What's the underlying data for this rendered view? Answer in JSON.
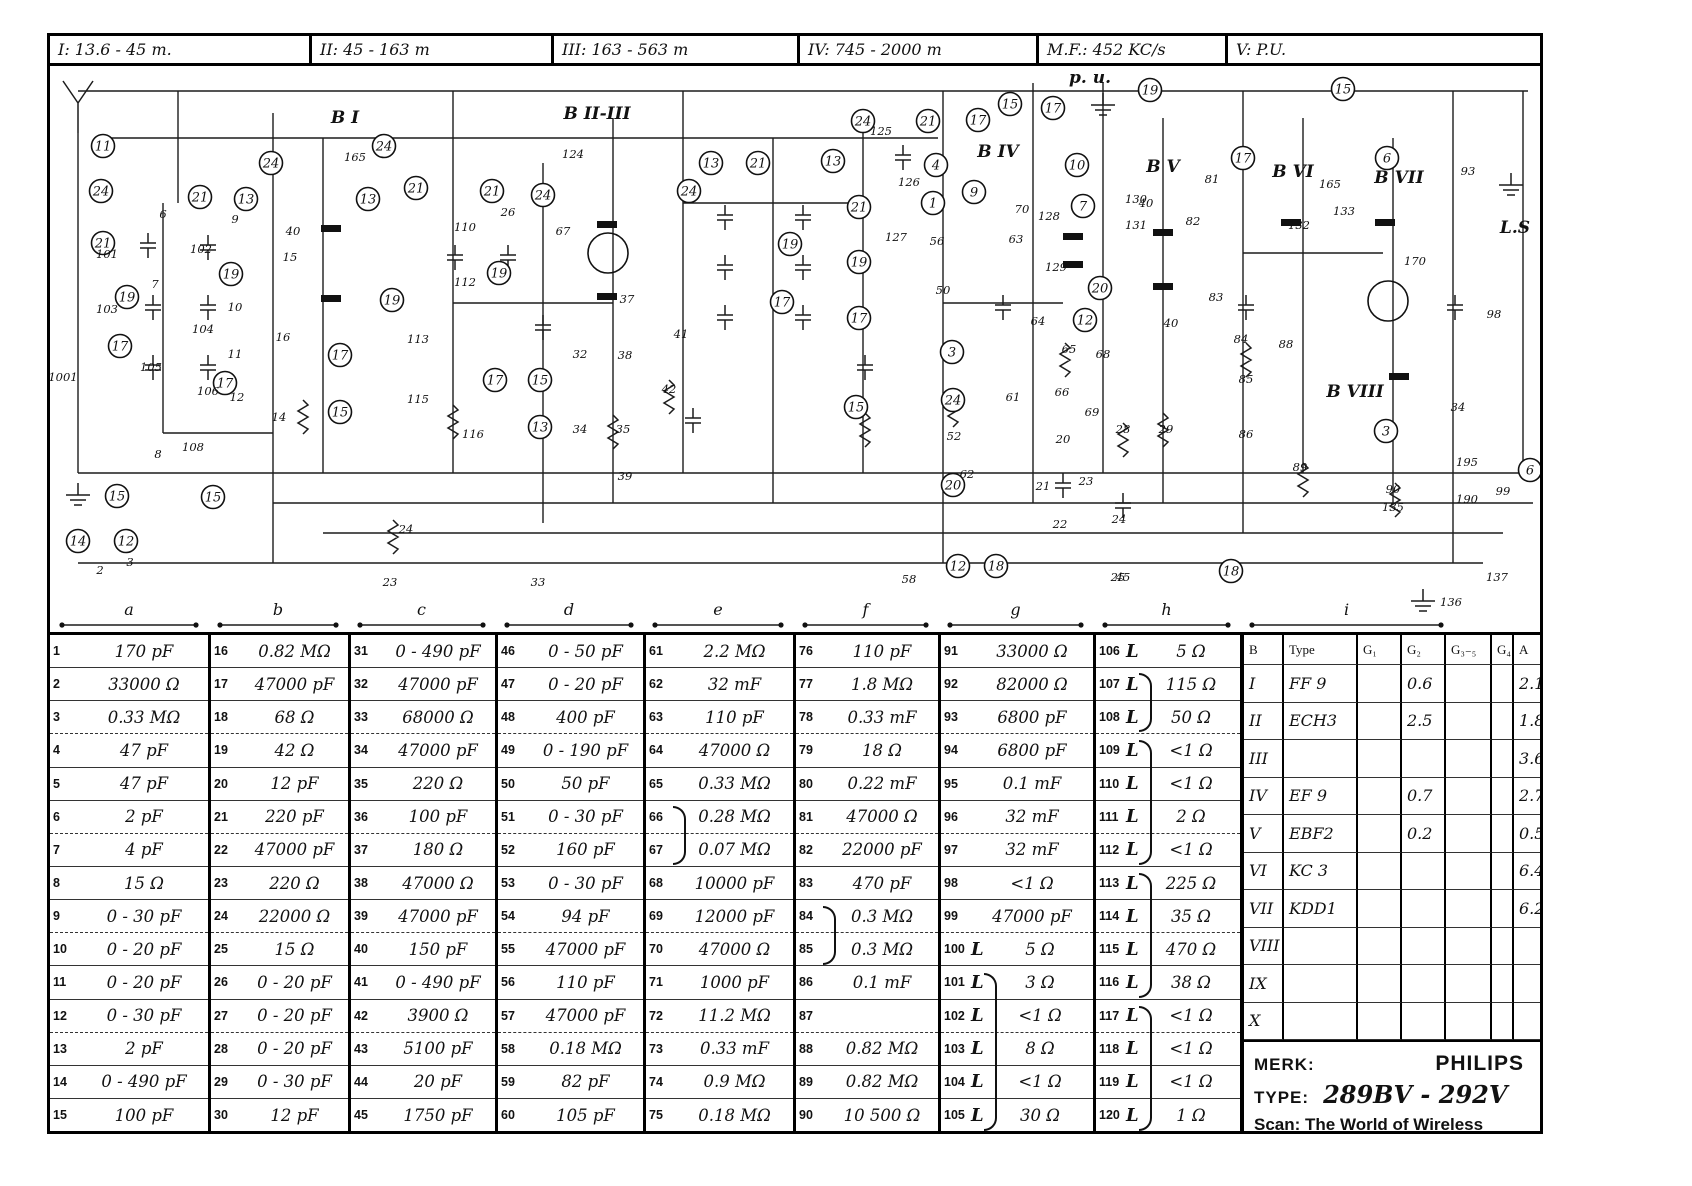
{
  "bands": [
    {
      "label": "I: 13.6 - 45 m."
    },
    {
      "label": "II: 45 - 163 m"
    },
    {
      "label": "III: 163 - 563 m"
    },
    {
      "label": "IV: 745 - 2000 m"
    },
    {
      "label": "M.F.: 452 KC/s"
    },
    {
      "label": "V: P.U."
    }
  ],
  "parts": {
    "group_letters": [
      "a",
      "b",
      "c",
      "d",
      "e",
      "f",
      "g",
      "h",
      "i"
    ],
    "entries": [
      [
        "1",
        "170 pF"
      ],
      [
        "2",
        "33000 Ω"
      ],
      [
        "3",
        "0.33 MΩ"
      ],
      [
        "4",
        "47 pF"
      ],
      [
        "5",
        "47 pF"
      ],
      [
        "6",
        "2 pF"
      ],
      [
        "7",
        "4 pF"
      ],
      [
        "8",
        "15 Ω"
      ],
      [
        "9",
        "0 - 30 pF"
      ],
      [
        "10",
        "0 - 20 pF"
      ],
      [
        "11",
        "0 - 20 pF"
      ],
      [
        "12",
        "0 - 30 pF"
      ],
      [
        "13",
        "2 pF"
      ],
      [
        "14",
        "0 - 490 pF"
      ],
      [
        "15",
        "100 pF"
      ],
      [
        "16",
        "0.82 MΩ"
      ],
      [
        "17",
        "47000 pF"
      ],
      [
        "18",
        "68 Ω"
      ],
      [
        "19",
        "42 Ω"
      ],
      [
        "20",
        "12 pF"
      ],
      [
        "21",
        "220 pF"
      ],
      [
        "22",
        "47000 pF"
      ],
      [
        "23",
        "220 Ω"
      ],
      [
        "24",
        "22000 Ω"
      ],
      [
        "25",
        "15 Ω"
      ],
      [
        "26",
        "0 - 20 pF"
      ],
      [
        "27",
        "0 - 20 pF"
      ],
      [
        "28",
        "0 - 20 pF"
      ],
      [
        "29",
        "0 - 30 pF"
      ],
      [
        "30",
        "12 pF"
      ],
      [
        "31",
        "0 - 490 pF"
      ],
      [
        "32",
        "47000 pF"
      ],
      [
        "33",
        "68000 Ω"
      ],
      [
        "34",
        "47000 pF"
      ],
      [
        "35",
        "220 Ω"
      ],
      [
        "36",
        "100 pF"
      ],
      [
        "37",
        "180 Ω"
      ],
      [
        "38",
        "47000 Ω"
      ],
      [
        "39",
        "47000 pF"
      ],
      [
        "40",
        "150 pF"
      ],
      [
        "41",
        "0 - 490 pF"
      ],
      [
        "42",
        "3900 Ω"
      ],
      [
        "43",
        "5100 pF"
      ],
      [
        "44",
        "20 pF"
      ],
      [
        "45",
        "1750 pF"
      ],
      [
        "46",
        "0 - 50 pF"
      ],
      [
        "47",
        "0 - 20 pF"
      ],
      [
        "48",
        "400 pF"
      ],
      [
        "49",
        "0 - 190 pF"
      ],
      [
        "50",
        "50 pF"
      ],
      [
        "51",
        "0 - 30 pF"
      ],
      [
        "52",
        "160 pF"
      ],
      [
        "53",
        "0 - 30 pF"
      ],
      [
        "54",
        "94 pF"
      ],
      [
        "55",
        "47000 pF"
      ],
      [
        "56",
        "110 pF"
      ],
      [
        "57",
        "47000 pF"
      ],
      [
        "58",
        "0.18 MΩ"
      ],
      [
        "59",
        "82 pF"
      ],
      [
        "60",
        "105 pF"
      ],
      [
        "61",
        "2.2 MΩ"
      ],
      [
        "62",
        "32 mF"
      ],
      [
        "63",
        "110 pF"
      ],
      [
        "64",
        "47000 Ω"
      ],
      [
        "65",
        "0.33 MΩ"
      ],
      [
        "66",
        "0.28 MΩ"
      ],
      [
        "67",
        "0.07 MΩ"
      ],
      [
        "68",
        "10000 pF"
      ],
      [
        "69",
        "12000 pF"
      ],
      [
        "70",
        "47000 Ω"
      ],
      [
        "71",
        "1000 pF"
      ],
      [
        "72",
        "11.2 MΩ"
      ],
      [
        "73",
        "0.33 mF"
      ],
      [
        "74",
        "0.9 MΩ"
      ],
      [
        "75",
        "0.18 MΩ"
      ],
      [
        "76",
        "110 pF"
      ],
      [
        "77",
        "1.8 MΩ"
      ],
      [
        "78",
        "0.33 mF"
      ],
      [
        "79",
        "18 Ω"
      ],
      [
        "80",
        "0.22 mF"
      ],
      [
        "81",
        "47000 Ω"
      ],
      [
        "82",
        "22000 pF"
      ],
      [
        "83",
        "470 pF"
      ],
      [
        "84",
        "0.3 MΩ"
      ],
      [
        "85",
        "0.3 MΩ"
      ],
      [
        "86",
        "0.1 mF"
      ],
      [
        "87",
        ""
      ],
      [
        "88",
        "0.82 MΩ"
      ],
      [
        "89",
        "0.82 MΩ"
      ],
      [
        "90",
        "10 500 Ω"
      ],
      [
        "91",
        "33000 Ω"
      ],
      [
        "92",
        "82000 Ω"
      ],
      [
        "93",
        "6800 pF"
      ],
      [
        "94",
        "6800 pF"
      ],
      [
        "95",
        "0.1 mF"
      ],
      [
        "96",
        "32 mF"
      ],
      [
        "97",
        "32 mF"
      ],
      [
        "98",
        "<1 Ω"
      ],
      [
        "99",
        "47000 pF"
      ],
      [
        "100",
        "5 Ω",
        "L"
      ],
      [
        "101",
        "3 Ω",
        "L"
      ],
      [
        "102",
        "<1 Ω",
        "L"
      ],
      [
        "103",
        "8 Ω",
        "L"
      ],
      [
        "104",
        "<1 Ω",
        "L"
      ],
      [
        "105",
        "30 Ω",
        "L"
      ],
      [
        "106",
        "5 Ω",
        "L"
      ],
      [
        "107",
        "115 Ω",
        "L"
      ],
      [
        "108",
        "50 Ω",
        "L"
      ],
      [
        "109",
        "<1 Ω",
        "L"
      ],
      [
        "110",
        "<1 Ω",
        "L"
      ],
      [
        "111",
        "2 Ω",
        "L"
      ],
      [
        "112",
        "<1 Ω",
        "L"
      ],
      [
        "113",
        "225 Ω",
        "L"
      ],
      [
        "114",
        "35 Ω",
        "L"
      ],
      [
        "115",
        "470 Ω",
        "L"
      ],
      [
        "116",
        "38 Ω",
        "L"
      ],
      [
        "117",
        "<1 Ω",
        "L"
      ],
      [
        "118",
        "<1 Ω",
        "L"
      ],
      [
        "119",
        "<1 Ω",
        "L"
      ],
      [
        "120",
        "1 Ω",
        "L"
      ]
    ],
    "braces": [
      {
        "c": 4,
        "f": 5,
        "t": 6
      },
      {
        "c": 5,
        "f": 8,
        "t": 9
      },
      {
        "c": 6,
        "f": 10,
        "t": 14
      },
      {
        "c": 7,
        "f": 1,
        "t": 2
      },
      {
        "c": 7,
        "f": 3,
        "t": 6
      },
      {
        "c": 7,
        "f": 7,
        "t": 10
      },
      {
        "c": 7,
        "f": 11,
        "t": 14
      }
    ]
  },
  "tubes": {
    "headers": [
      "B",
      "Type",
      "G₁",
      "G₂",
      "G₃₋₅",
      "G₄",
      "A"
    ],
    "rows": [
      {
        "b": "I",
        "type": "FF 9",
        "g1": "",
        "g2": "0.6",
        "g35": "",
        "g4": "",
        "a": "2.1"
      },
      {
        "b": "II",
        "type": "ECH3",
        "g1": "",
        "g2": "2.5",
        "g35": "",
        "g4": "",
        "a": "1.8"
      },
      {
        "b": "III",
        "type": "",
        "g1": "",
        "g2": "",
        "g35": "",
        "g4": "",
        "a": "3.6"
      },
      {
        "b": "IV",
        "type": "EF 9",
        "g1": "",
        "g2": "0.7",
        "g35": "",
        "g4": "",
        "a": "2.7"
      },
      {
        "b": "V",
        "type": "EBF2",
        "g1": "",
        "g2": "0.2",
        "g35": "",
        "g4": "",
        "a": "0.5"
      },
      {
        "b": "VI",
        "type": "KC 3",
        "g1": "",
        "g2": "",
        "g35": "",
        "g4": "",
        "a": "6.4"
      },
      {
        "b": "VII",
        "type": "KDD1",
        "g1": "",
        "g2": "",
        "g35": "",
        "g4": "",
        "a": "6.2"
      },
      {
        "b": "VIII",
        "type": "",
        "g1": "",
        "g2": "",
        "g35": "",
        "g4": "",
        "a": ""
      },
      {
        "b": "IX",
        "type": "",
        "g1": "",
        "g2": "",
        "g35": "",
        "g4": "",
        "a": ""
      },
      {
        "b": "X",
        "type": "",
        "g1": "",
        "g2": "",
        "g35": "",
        "g4": "",
        "a": ""
      }
    ]
  },
  "brand": {
    "merk_label": "MERK:",
    "merk_value": "PHILIPS",
    "type_label": "TYPE:",
    "type_value": "289BV - 292V",
    "scan": "Scan: The World of Wireless"
  },
  "schematic": {
    "block_labels": [
      [
        "B I",
        342,
        120
      ],
      [
        "B II-III",
        594,
        116
      ],
      [
        "B IV",
        995,
        154
      ],
      [
        "B V",
        1160,
        169
      ],
      [
        "B VI",
        1290,
        174
      ],
      [
        "B VII",
        1396,
        180
      ],
      [
        "B VIII",
        1352,
        394
      ],
      [
        "p. u.",
        1087,
        80
      ],
      [
        "L.S",
        1512,
        230
      ]
    ],
    "circles": [
      [
        11,
        100,
        143
      ],
      [
        24,
        98,
        188
      ],
      [
        21,
        100,
        240
      ],
      [
        19,
        124,
        294
      ],
      [
        17,
        117,
        343
      ],
      [
        15,
        114,
        493
      ],
      [
        14,
        75,
        538
      ],
      [
        12,
        123,
        538
      ],
      [
        21,
        197,
        194
      ],
      [
        13,
        243,
        196
      ],
      [
        19,
        228,
        271
      ],
      [
        17,
        222,
        380
      ],
      [
        15,
        210,
        494
      ],
      [
        24,
        268,
        160
      ],
      [
        13,
        365,
        196
      ],
      [
        24,
        381,
        143
      ],
      [
        21,
        413,
        185
      ],
      [
        19,
        389,
        297
      ],
      [
        17,
        337,
        352
      ],
      [
        15,
        337,
        409
      ],
      [
        21,
        489,
        188
      ],
      [
        19,
        496,
        270
      ],
      [
        24,
        540,
        192
      ],
      [
        17,
        492,
        377
      ],
      [
        15,
        537,
        377
      ],
      [
        13,
        537,
        424
      ],
      [
        24,
        686,
        188
      ],
      [
        13,
        708,
        160
      ],
      [
        21,
        755,
        160
      ],
      [
        19,
        787,
        241
      ],
      [
        17,
        779,
        299
      ],
      [
        13,
        830,
        158
      ],
      [
        21,
        856,
        204
      ],
      [
        19,
        856,
        259
      ],
      [
        17,
        856,
        315
      ],
      [
        15,
        853,
        404
      ],
      [
        24,
        860,
        118
      ],
      [
        21,
        925,
        118
      ],
      [
        4,
        933,
        162
      ],
      [
        1,
        930,
        200
      ],
      [
        9,
        971,
        189
      ],
      [
        3,
        949,
        349
      ],
      [
        24,
        950,
        397
      ],
      [
        20,
        950,
        482
      ],
      [
        12,
        955,
        563
      ],
      [
        18,
        993,
        563
      ],
      [
        17,
        975,
        117
      ],
      [
        15,
        1007,
        101
      ],
      [
        10,
        1074,
        162
      ],
      [
        7,
        1080,
        203
      ],
      [
        17,
        1050,
        105
      ],
      [
        20,
        1097,
        285
      ],
      [
        12,
        1082,
        317
      ],
      [
        17,
        1240,
        155
      ],
      [
        6,
        1384,
        155
      ],
      [
        3,
        1383,
        428
      ],
      [
        18,
        1228,
        568
      ],
      [
        19,
        1147,
        87
      ],
      [
        15,
        1340,
        86
      ],
      [
        6,
        1527,
        467
      ]
    ],
    "labels": [
      [
        "165",
        352,
        158
      ],
      [
        "124",
        570,
        155
      ],
      [
        "125",
        878,
        132
      ],
      [
        "126",
        906,
        183
      ],
      [
        "127",
        893,
        238
      ],
      [
        "128",
        1046,
        217
      ],
      [
        "129",
        1053,
        268
      ],
      [
        "130",
        1133,
        200
      ],
      [
        "131",
        1133,
        226
      ],
      [
        "40",
        290,
        232
      ],
      [
        "40",
        1143,
        204
      ],
      [
        "40",
        1168,
        324
      ],
      [
        "50",
        940,
        291
      ],
      [
        "56",
        934,
        242
      ],
      [
        "52",
        951,
        437
      ],
      [
        "61",
        1010,
        398
      ],
      [
        "62",
        964,
        475
      ],
      [
        "63",
        1013,
        240
      ],
      [
        "64",
        1035,
        322
      ],
      [
        "65",
        1066,
        350
      ],
      [
        "66",
        1059,
        393
      ],
      [
        "68",
        1100,
        355
      ],
      [
        "69",
        1089,
        413
      ],
      [
        "20",
        1060,
        440
      ],
      [
        "21",
        1040,
        487
      ],
      [
        "22",
        1057,
        525
      ],
      [
        "23",
        1083,
        482
      ],
      [
        "24",
        1116,
        520
      ],
      [
        "25",
        1115,
        578
      ],
      [
        "28",
        1120,
        430
      ],
      [
        "29",
        1163,
        430
      ],
      [
        "70",
        1019,
        210
      ],
      [
        "81",
        1209,
        180
      ],
      [
        "82",
        1190,
        222
      ],
      [
        "83",
        1213,
        298
      ],
      [
        "84",
        1238,
        340
      ],
      [
        "85",
        1243,
        380
      ],
      [
        "86",
        1243,
        435
      ],
      [
        "88",
        1283,
        345
      ],
      [
        "89",
        1297,
        468
      ],
      [
        "90",
        1390,
        490
      ],
      [
        "135",
        1390,
        508
      ],
      [
        "132",
        1296,
        226
      ],
      [
        "133",
        1341,
        212
      ],
      [
        "165",
        1327,
        185
      ],
      [
        "170",
        1412,
        262
      ],
      [
        "93",
        1465,
        172
      ],
      [
        "98",
        1491,
        315
      ],
      [
        "34",
        1455,
        408
      ],
      [
        "195",
        1464,
        463
      ],
      [
        "190",
        1464,
        500
      ],
      [
        "99",
        1500,
        492
      ],
      [
        "137",
        1494,
        578
      ],
      [
        "136",
        1448,
        603
      ],
      [
        "23",
        387,
        583
      ],
      [
        "24",
        403,
        530
      ],
      [
        "33",
        535,
        583
      ],
      [
        "58",
        906,
        580
      ],
      [
        "45",
        1120,
        578
      ],
      [
        "67",
        560,
        232
      ],
      [
        "26",
        505,
        213
      ],
      [
        "37",
        624,
        300
      ],
      [
        "38",
        622,
        356
      ],
      [
        "32",
        577,
        355
      ],
      [
        "34",
        577,
        430
      ],
      [
        "35",
        620,
        430
      ],
      [
        "39",
        622,
        477
      ],
      [
        "41",
        678,
        335
      ],
      [
        "42",
        666,
        390
      ],
      [
        "101",
        104,
        255
      ],
      [
        "102",
        198,
        250
      ],
      [
        "103",
        104,
        310
      ],
      [
        "104",
        200,
        330
      ],
      [
        "105",
        148,
        368
      ],
      [
        "106",
        205,
        392
      ],
      [
        "108",
        190,
        448
      ],
      [
        "110",
        462,
        228
      ],
      [
        "112",
        462,
        283
      ],
      [
        "113",
        415,
        340
      ],
      [
        "115",
        415,
        400
      ],
      [
        "116",
        470,
        435
      ],
      [
        "6",
        160,
        215
      ],
      [
        "9",
        232,
        220
      ],
      [
        "7",
        152,
        285
      ],
      [
        "10",
        232,
        308
      ],
      [
        "11",
        232,
        355
      ],
      [
        "12",
        234,
        398
      ],
      [
        "8",
        155,
        455
      ],
      [
        "14",
        276,
        418
      ],
      [
        "16",
        280,
        338
      ],
      [
        "15",
        287,
        258
      ],
      [
        "2",
        97,
        571
      ],
      [
        "3",
        127,
        563
      ],
      [
        "1001",
        60,
        378
      ]
    ],
    "bars": [
      [
        318,
        222
      ],
      [
        318,
        292
      ],
      [
        594,
        218
      ],
      [
        594,
        290
      ],
      [
        1060,
        230
      ],
      [
        1060,
        258
      ],
      [
        1150,
        226
      ],
      [
        1150,
        280
      ],
      [
        1278,
        216
      ],
      [
        1372,
        216
      ],
      [
        1386,
        370
      ]
    ]
  }
}
